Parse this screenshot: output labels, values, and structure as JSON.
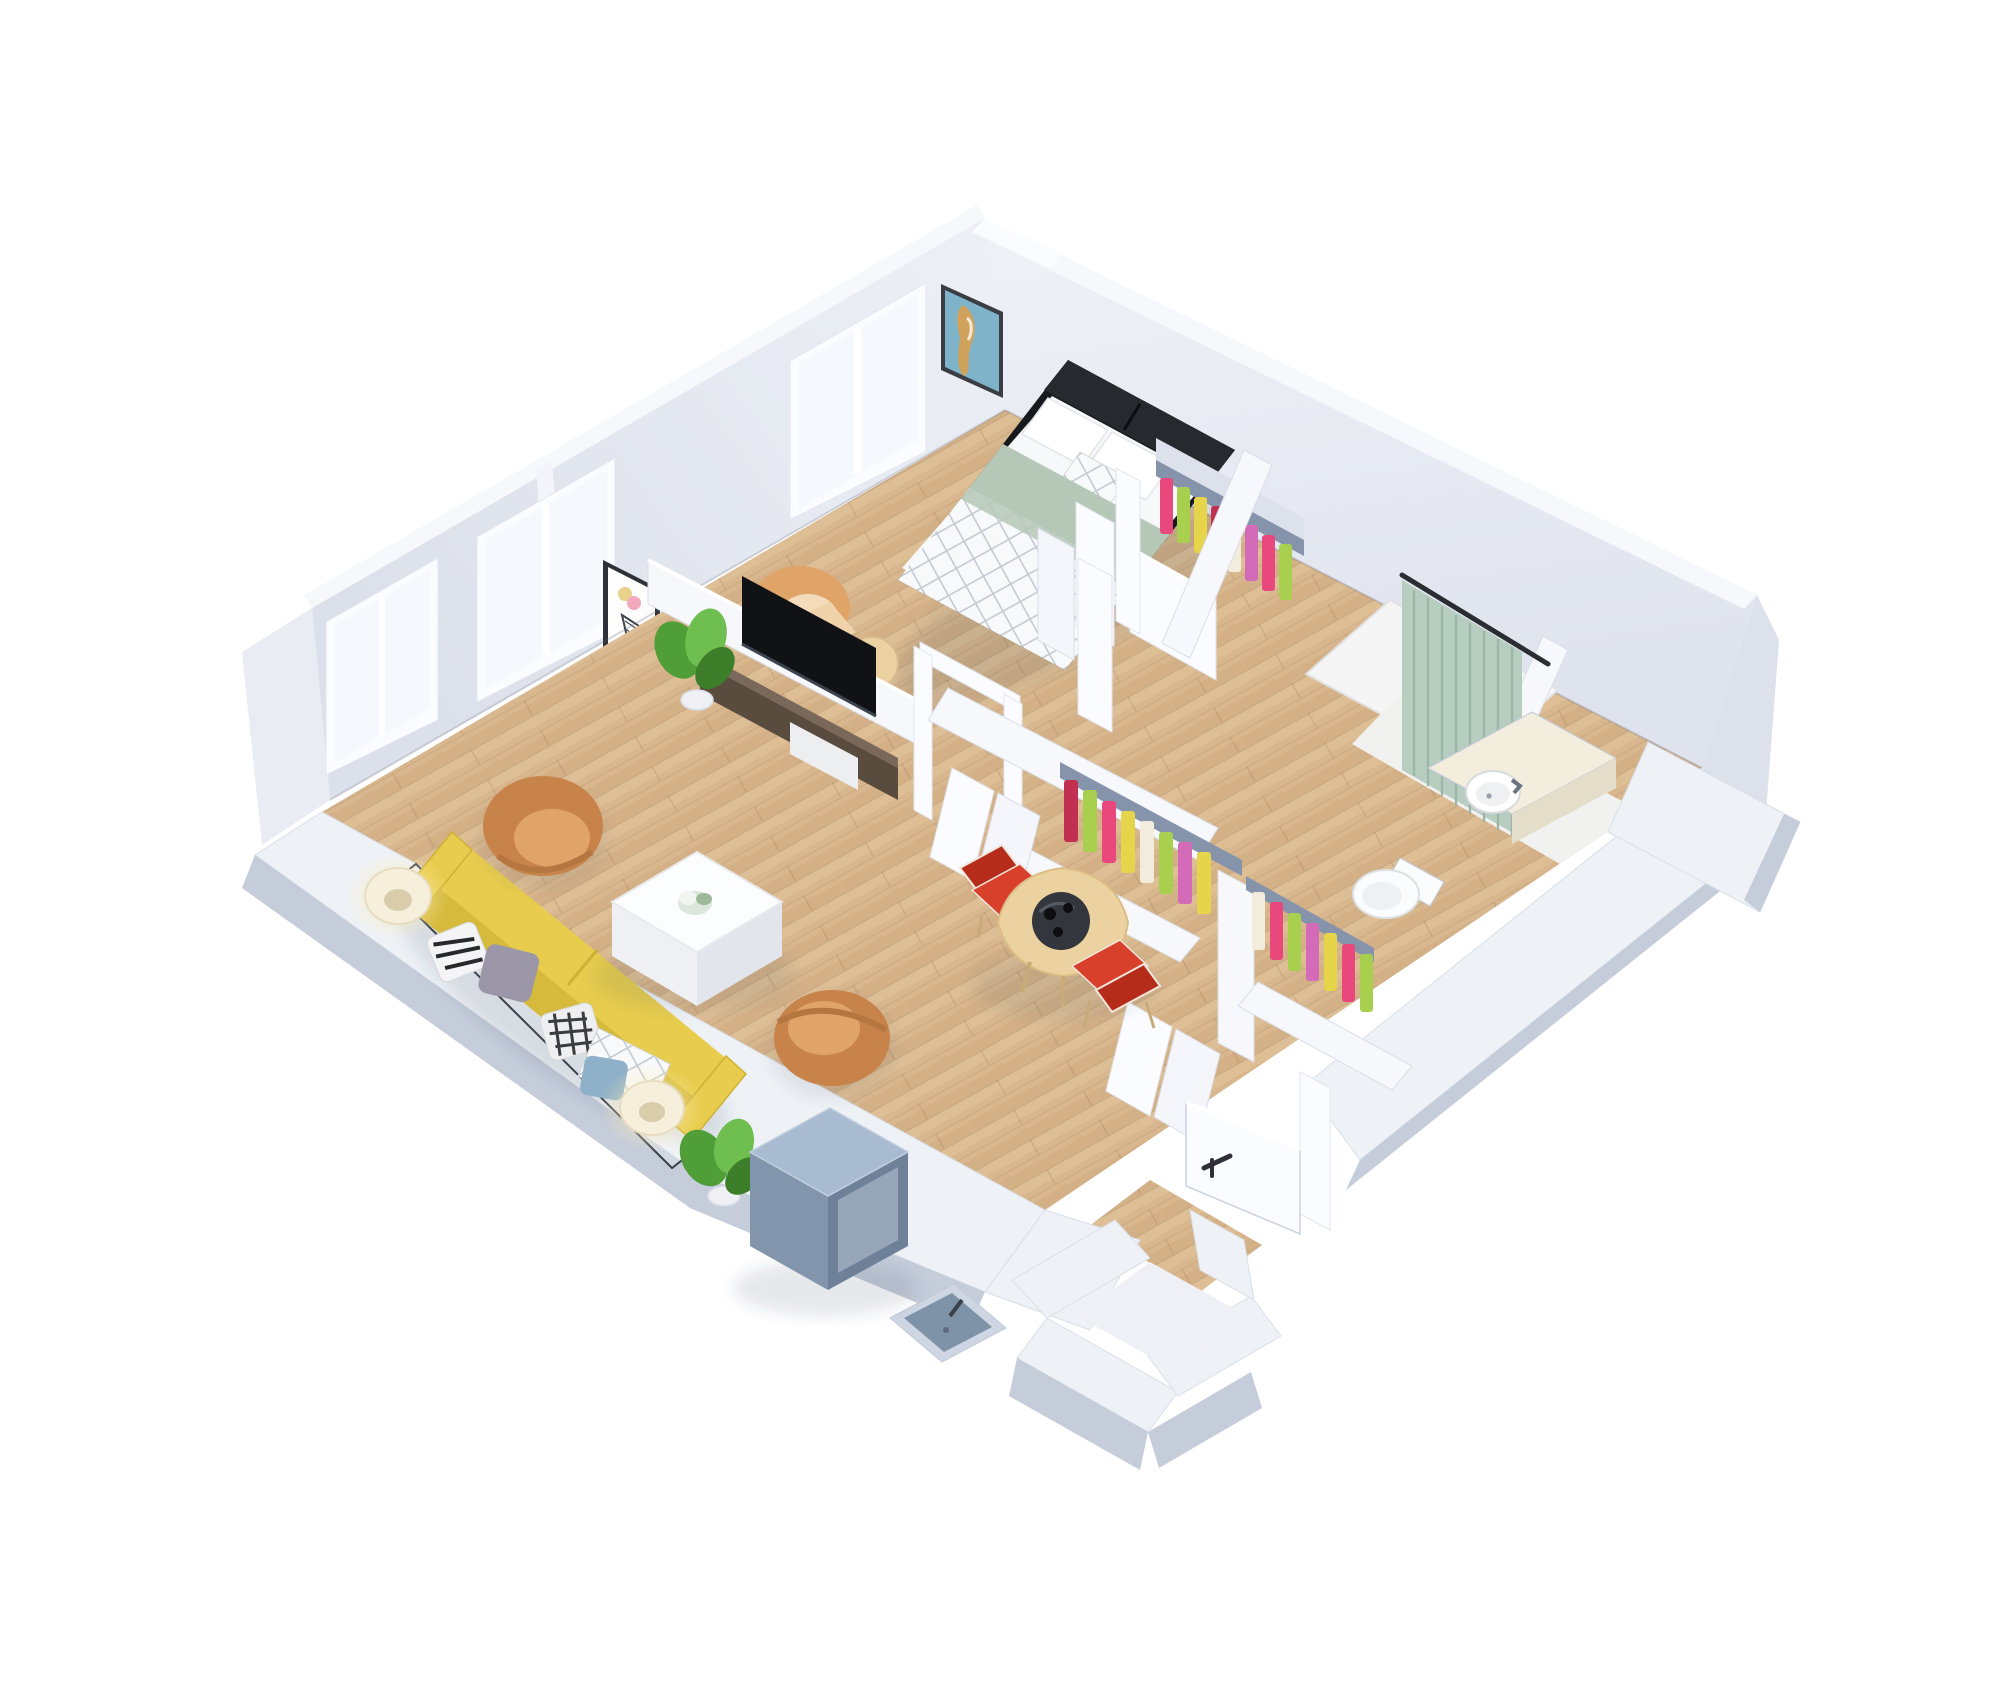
{
  "scene": {
    "title": "3D isometric floor plan render of a one-bedroom apartment viewed from above",
    "background": "#ffffff"
  },
  "colors": {
    "wall_face": "#e9ecf3",
    "wall_face_dark": "#dde1eb",
    "wall_top": "#f6f8fc",
    "wall_band": "#eef1f6",
    "wall_side": "#c5ccda",
    "wall_bright": "#fbfcff",
    "glass": "#f5f9fd",
    "wood_base": "#d9b78e",
    "wood_light": "#e2c29b",
    "wood_dark": "#cfa97e",
    "white_floor": "#f4f5f4",
    "sofa": "#e7cc4d",
    "sofa_dark": "#d5ba3c",
    "armchair": "#c8834a",
    "armchair_light": "#e0a468",
    "coffee_table": "#fcfdfe",
    "bed_duvet": "#f7f8fa",
    "bed_sage": "#b5c8b7",
    "headboard": "#26292e",
    "bed_frame": "#17191d",
    "tv_stand": "#5a4b3f",
    "tv_stand_top": "#7a685a",
    "tv_screen": "#101216",
    "dining_table": "#ecd2a0",
    "tray": "#33363c",
    "chair_red": "#d8402c",
    "chair_red_dark": "#b52d1a",
    "curtain": "#b7cdc0",
    "curtain_fold": "#9cb6a8",
    "clothes": [
      "#e8487c",
      "#a8cf4d",
      "#e6d44a",
      "#c13050",
      "#f2ecdc",
      "#d36bb8"
    ],
    "rack": "#8694ab",
    "cube_top": "#a9bbd0",
    "cube_left": "#8295ac",
    "cube_right": "#6f8199",
    "lamp_shade": "#f6efdb",
    "lamp_glow": "#ffedb8",
    "plant": "#4f9e38",
    "plant_dark": "#3c7e2a",
    "plant_light": "#6fbe50",
    "pot": "#eef0f4",
    "basin": "#ffffff",
    "counter": "#f2eddc",
    "counter_side": "#e3ddc9",
    "toilet": "#fbfcfd",
    "art_teal": "#7fb3c9",
    "art_orange": "#d9a050",
    "art_pink": "#f2a9bb",
    "art_yellow": "#e9d28b",
    "utility_rim": "#cdd6e2",
    "utility_basin": "#7e92a8",
    "handle": "#2e3238",
    "pillow_gray": "#9b97a8",
    "pillow_blue": "#8fb0c9",
    "pillow_white": "#f2f3f5",
    "shadow": "#3a4456"
  },
  "rooms": [
    {
      "name": "bedroom",
      "items": [
        "double bed with white duvet, sage runner and plaid throw",
        "black headboard",
        "two white pillows",
        "plaid cushion",
        "cream accent chair",
        "round side table",
        "abstract teal wall art",
        "window",
        "reach-in closet with hanging clothes"
      ]
    },
    {
      "name": "living-room",
      "items": [
        "yellow three-seat sofa",
        "five patterned throw pillows",
        "two caramel tub armchairs",
        "white cube coffee table with flowers",
        "dark wood TV stand",
        "flat-screen TV",
        "two table lamps on glass side tables",
        "two potted plants",
        "geometric wall art",
        "two windows"
      ]
    },
    {
      "name": "dining-nook",
      "items": [
        "round maple dining table",
        "black lazy-susan tray",
        "two red dining chairs"
      ]
    },
    {
      "name": "bathroom",
      "items": [
        "walk-in shower with sage curtain",
        "round white basin on vanity counter",
        "toilet"
      ]
    },
    {
      "name": "hall-closets",
      "items": [
        "two open closets with colorful hanging clothes",
        "white folding doors"
      ]
    },
    {
      "name": "entry",
      "items": [
        "open white front door with black handle",
        "white vestibule walls",
        "wall-mounted utility sink",
        "blue-grey cabinet cube"
      ]
    }
  ]
}
